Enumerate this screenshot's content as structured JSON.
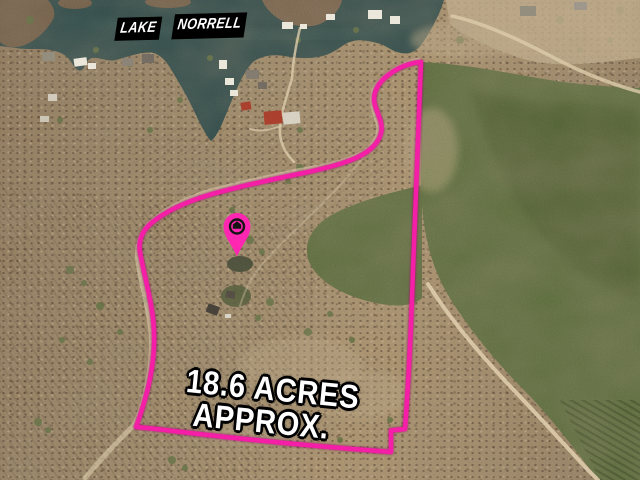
{
  "lake_label": {
    "word1": "LAKE",
    "word2": "NORRELL"
  },
  "acreage_label": {
    "line1": "18.6 ACRES",
    "line2": "APPROX."
  },
  "pin": {
    "icon": "house-location-pin-icon"
  },
  "colors": {
    "boundary": "#f41fa6",
    "pin": "#ff27b1",
    "pin_glyph": "#141414",
    "water": "#2e4948",
    "water_deep": "#223c3d",
    "terrain_dark": "#6d5a45",
    "terrain_pale": "#c3ae89",
    "pine": "#5a6a3d",
    "pine_dark": "#3d4a29",
    "road": "#dbc9a5",
    "dock": "#eae6d9",
    "roof_red": "#a63c2b",
    "roof_gray": "#8d8778",
    "label_bg": "#000000",
    "label_text": "#ffffff",
    "acreage_text": "#ffffff",
    "acreage_outline": "#000000"
  }
}
